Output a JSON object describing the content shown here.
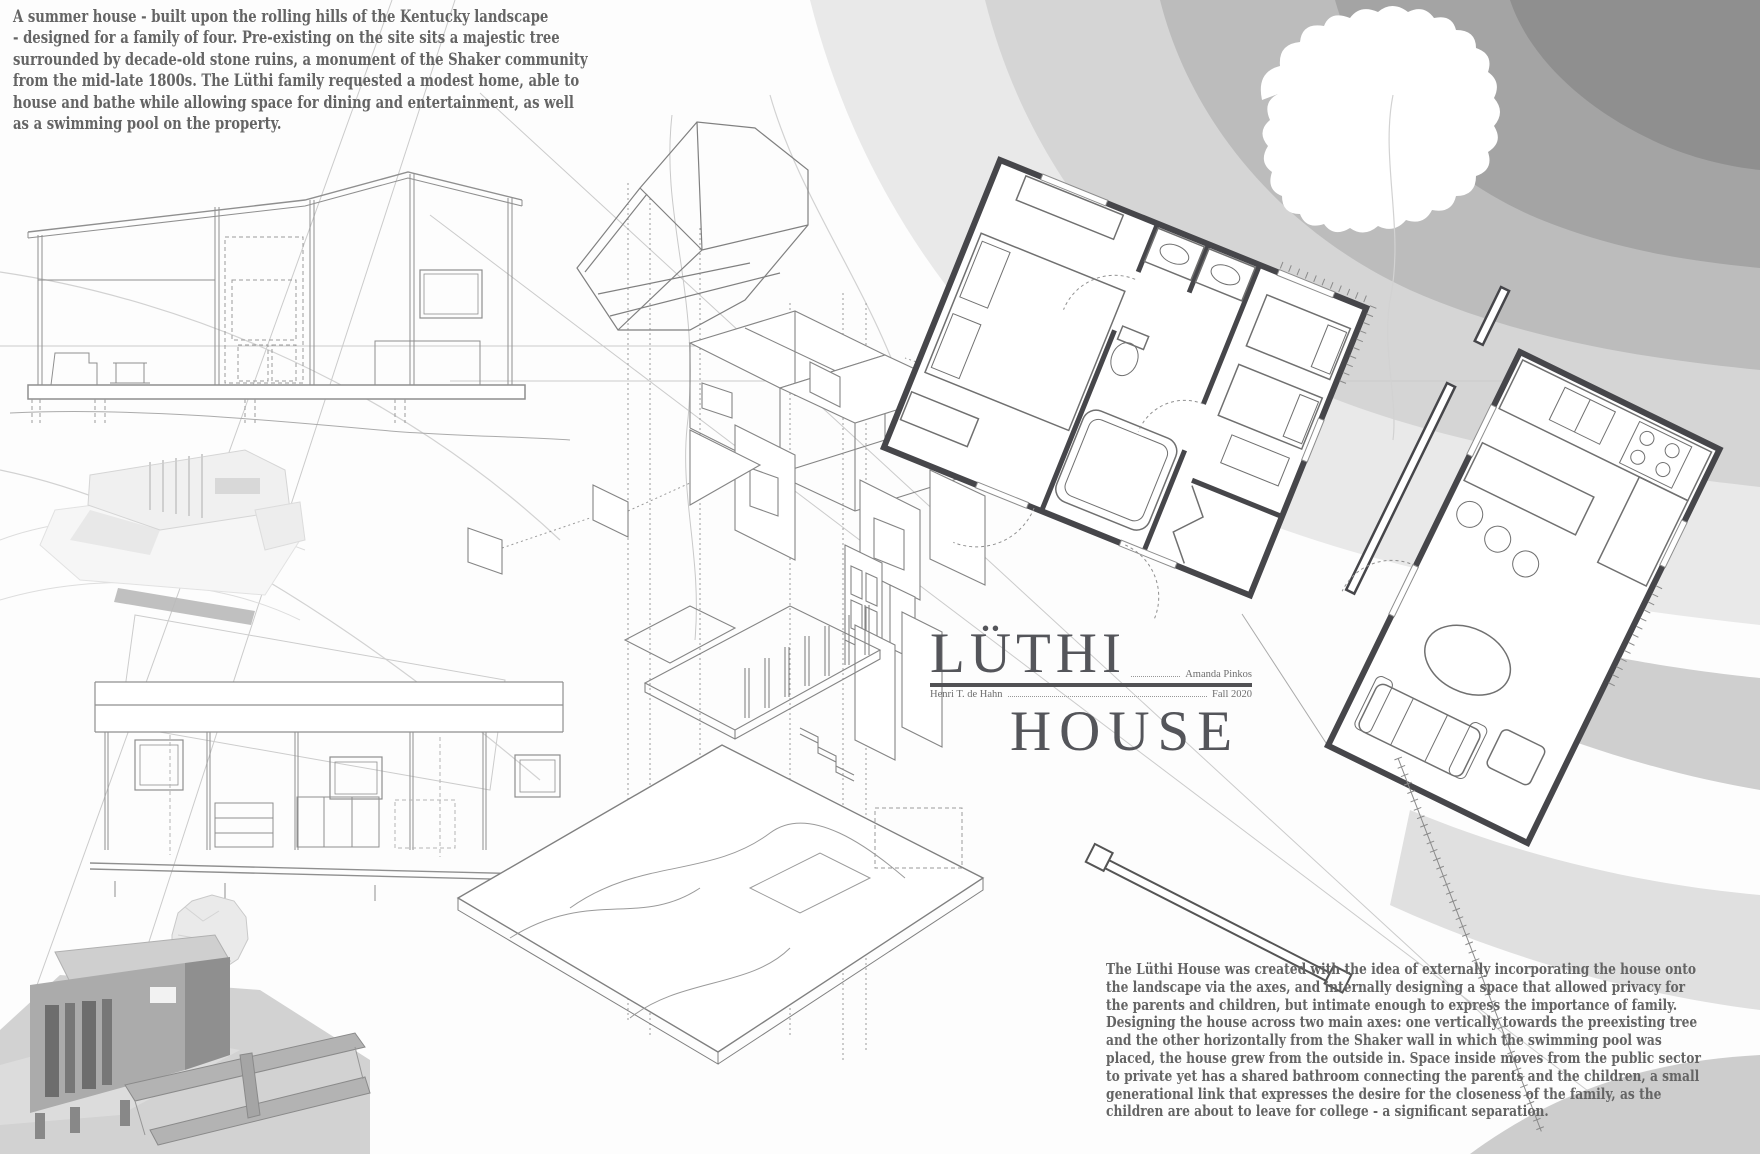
{
  "board": {
    "intro": {
      "lines": [
        "A summer house - built upon the rolling hills of the Kentucky landscape",
        "- designed for a family of four. Pre-existing on the site sits a majestic tree",
        "surrounded by decade-old stone ruins, a monument of the Shaker community",
        "from the mid-late 1800s. The Lüthi family requested a modest home, able to",
        "house and bathe while allowing space for dining and entertainment, as well",
        "as a swimming pool on the property."
      ]
    },
    "description": {
      "lines": [
        "The Lüthi House was created with the idea of externally incorporating the house onto",
        "the landscape via the axes, and internally designing a space that allowed privacy for",
        "the parents and children, but intimate enough to express the importance of family.",
        "Designing the house across two main axes: one vertically towards the preexisting tree",
        "and the other horizontally from the Shaker wall in which the swimming pool was",
        "placed, the house grew from the outside in. Space inside moves from the public sector",
        "to private yet has a shared bathroom connecting the parents and the children, a small",
        "generational link that expresses the desire for the closeness of the family, as the",
        "children are about to leave for college - a significant separation."
      ]
    },
    "title_block": {
      "line1": "LÜTHI",
      "line2": "HOUSE",
      "student": "Amanda Pinkos",
      "professor": "Henri T. de Hahn",
      "term": "Fall 2020"
    },
    "palette": {
      "title_color": "#54555a",
      "body_text_color": "#646464",
      "pencil_line": "#8f8f8f",
      "plan_wall": "#46464a",
      "terrain_band_1": "#e9e9e9",
      "terrain_band_2": "#d5d5d5",
      "terrain_band_3": "#bcbcbc",
      "terrain_band_4": "#a4a4a4",
      "terrain_band_5": "#8f8f8f",
      "model_gray": "#ababab",
      "pool_gray": "#b9b9b9"
    },
    "figures": {
      "top_left": "building-section-drawing",
      "middle_left": "white-study-model-photo",
      "lower_left": "long-elevation-drawing",
      "bottom_left": "site-model-photo",
      "center": "exploded-axonometric-drawing",
      "top_center": "roof-plan-axonometric",
      "right": "rotated-floor-plan",
      "top_right": "terrain-contours-with-tree"
    }
  }
}
